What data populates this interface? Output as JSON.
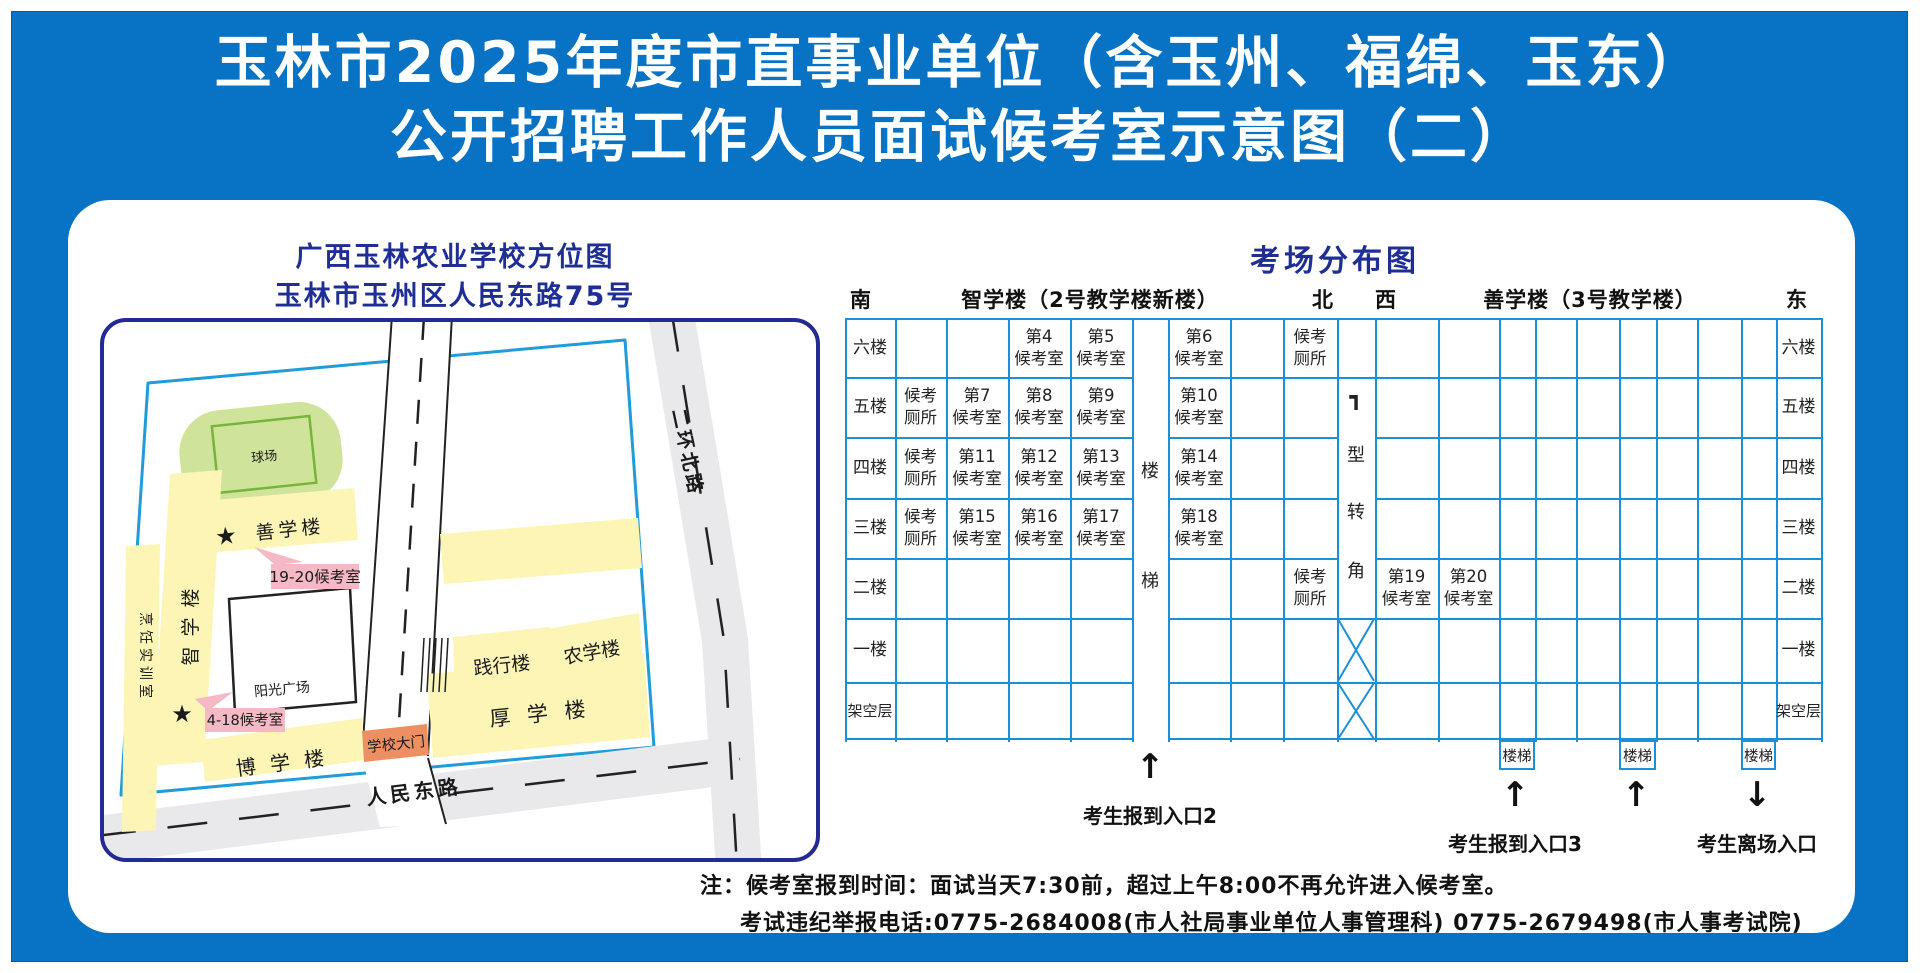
{
  "title": {
    "line1": "玉林市2025年度市直事业单位（含玉州、福绵、玉东）",
    "line2": "公开招聘工作人员面试候考室示意图（二）"
  },
  "campus_map": {
    "heading1": "广西玉林农业学校方位图",
    "heading2": "玉林市玉州区人民东路75号",
    "ball_field": "球场",
    "buildings": {
      "shanxue": "善学楼",
      "zhixue": "智学楼",
      "cooking": "烹饪实训室",
      "boxue": "博 学 楼",
      "houxue": "厚 学 楼",
      "jianxing": "践行楼",
      "nongxue": "农学楼"
    },
    "plaza": "阳光广场",
    "gate": "学校大门",
    "roads": {
      "north": "二环北路",
      "south": "人民东路"
    },
    "pink_labels": {
      "rooms_19_20": "19-20候考室",
      "rooms_4_18": "4-18候考室"
    },
    "star": "★"
  },
  "exam_map": {
    "title": "考场分布图",
    "compass": {
      "south": "南",
      "north": "北",
      "west": "西",
      "east": "东"
    },
    "left_building": "智学楼（2号教学楼新楼）",
    "right_building": "善学楼（3号教学楼）",
    "floors": [
      "六楼",
      "五楼",
      "四楼",
      "三楼",
      "二楼",
      "一楼",
      "架空层"
    ],
    "toilet_label": "候考厕所",
    "stair_vertical": [
      "楼",
      "梯"
    ],
    "corner_vertical": [
      "┓",
      "型",
      "转",
      "角"
    ],
    "stair_box_label": "楼梯",
    "room_suffix": "候考室",
    "left_rooms": [
      {
        "floor_index": 0,
        "col": 3,
        "number": "第4"
      },
      {
        "floor_index": 0,
        "col": 4,
        "number": "第5"
      },
      {
        "floor_index": 0,
        "col": 5,
        "number": "第6"
      },
      {
        "floor_index": 1,
        "col": 2,
        "number": "第7"
      },
      {
        "floor_index": 1,
        "col": 3,
        "number": "第8"
      },
      {
        "floor_index": 1,
        "col": 4,
        "number": "第9"
      },
      {
        "floor_index": 1,
        "col": 5,
        "number": "第10"
      },
      {
        "floor_index": 2,
        "col": 2,
        "number": "第11"
      },
      {
        "floor_index": 2,
        "col": 3,
        "number": "第12"
      },
      {
        "floor_index": 2,
        "col": 4,
        "number": "第13"
      },
      {
        "floor_index": 2,
        "col": 5,
        "number": "第14"
      },
      {
        "floor_index": 3,
        "col": 2,
        "number": "第15"
      },
      {
        "floor_index": 3,
        "col": 3,
        "number": "第16"
      },
      {
        "floor_index": 3,
        "col": 4,
        "number": "第17"
      },
      {
        "floor_index": 3,
        "col": 5,
        "number": "第18"
      }
    ],
    "left_toilets": [
      {
        "floor_index": 0,
        "col": 7
      },
      {
        "floor_index": 1,
        "col": 1
      },
      {
        "floor_index": 2,
        "col": 1
      },
      {
        "floor_index": 3,
        "col": 1
      },
      {
        "floor_index": 4,
        "col": 7
      }
    ],
    "right_rooms": [
      {
        "floor_index": 4,
        "col": 0,
        "number": "第19"
      },
      {
        "floor_index": 4,
        "col": 1,
        "number": "第20"
      }
    ],
    "entrance2": "考生报到入口2",
    "entrance3": "考生报到入口3",
    "exit_label": "考生离场入口",
    "arrow_up": "↑",
    "arrow_down": "↓"
  },
  "notes": {
    "line1": "注：候考室报到时间：面试当天7:30前，超过上午8:00不再允许进入候考室。",
    "line2": "考试违纪举报电话:0775-2684008(市人社局事业单位人事管理科)  0775-2679498(市人事考试院)"
  },
  "colors": {
    "canvas_blue": "#0873c4",
    "navy": "#1f2e95",
    "grid_blue": "#1b8fd8",
    "building_yellow": "#fcf5b6",
    "field_green": "#cfe49a",
    "field_border": "#76b43e",
    "pink": "#f4b9c4",
    "gate_orange": "#ee8f63",
    "star_red": "#e60012",
    "road_gray": "#e9e9eb"
  }
}
